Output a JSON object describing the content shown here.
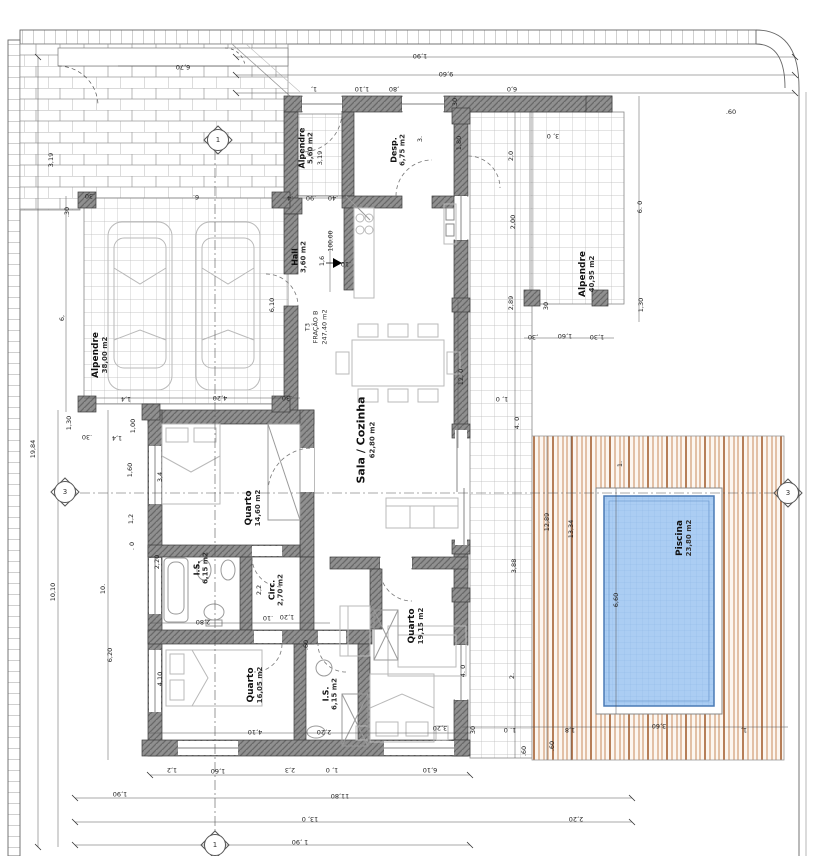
{
  "plan": {
    "fraction": {
      "line1": "T3",
      "line2": "FRAÇÃO B",
      "area": "247,40 m2"
    },
    "level_marker": "100.00",
    "rooms": [
      {
        "name": "Alpendre",
        "area": "38,00 m2",
        "x": 100,
        "y": 355,
        "fs": 9
      },
      {
        "name": "Alpendre",
        "area": "5,60 m2",
        "x": 306,
        "y": 148,
        "fs": 8
      },
      {
        "name": "Desp.",
        "area": "6,75 m2",
        "x": 398,
        "y": 150,
        "fs": 8
      },
      {
        "name": "Hall",
        "area": "3,60 m2",
        "x": 299,
        "y": 257,
        "fs": 8
      },
      {
        "name": "Sala / Cozinha",
        "area": "62,80 m2",
        "x": 366,
        "y": 440,
        "fs": 11
      },
      {
        "name": "Quarto",
        "area": "14,60 m2",
        "x": 253,
        "y": 508,
        "fs": 9
      },
      {
        "name": "I.S.",
        "area": "6,15 m2",
        "x": 201,
        "y": 568,
        "fs": 8
      },
      {
        "name": "Circ.",
        "area": "2,70 m2",
        "x": 276,
        "y": 590,
        "fs": 8
      },
      {
        "name": "Quarto",
        "area": "16,05 m2",
        "x": 255,
        "y": 685,
        "fs": 9
      },
      {
        "name": "I.S.",
        "area": "6,15 m2",
        "x": 330,
        "y": 694,
        "fs": 8
      },
      {
        "name": "Quarto",
        "area": "19,15 m2",
        "x": 416,
        "y": 626,
        "fs": 9
      },
      {
        "name": "Alpendre",
        "area": "40,95 m2",
        "x": 587,
        "y": 274,
        "fs": 9
      },
      {
        "name": "Piscina",
        "area": "23,80 m2",
        "x": 684,
        "y": 538,
        "fs": 9
      }
    ],
    "section_markers": [
      {
        "label": "1",
        "x": 218,
        "y": 140
      },
      {
        "label": "3",
        "x": 65,
        "y": 492
      },
      {
        "label": "3",
        "x": 788,
        "y": 493
      },
      {
        "label": "1",
        "x": 215,
        "y": 845
      }
    ],
    "dimensions": [
      {
        "t": "6,70",
        "x": 183,
        "y": 67,
        "r": 180
      },
      {
        "t": "1,90",
        "x": 420,
        "y": 56,
        "r": 180
      },
      {
        "t": "9,60",
        "x": 446,
        "y": 74,
        "r": 180
      },
      {
        "t": "1,",
        "x": 314,
        "y": 89,
        "r": 180
      },
      {
        "t": "1,10",
        "x": 362,
        "y": 89,
        "r": 180
      },
      {
        "t": ",80",
        "x": 394,
        "y": 89,
        "r": 180
      },
      {
        "t": "6,0",
        "x": 512,
        "y": 89,
        "r": 180
      },
      {
        "t": ".30",
        "x": 90,
        "y": 196,
        "r": 180
      },
      {
        "t": "6.",
        "x": 196,
        "y": 197,
        "r": 180
      },
      {
        "t": ".30",
        "x": 67,
        "y": 212,
        "r": -90
      },
      {
        "t": "6,",
        "x": 62,
        "y": 318,
        "r": -90
      },
      {
        "t": "6,10",
        "x": 272,
        "y": 305,
        "r": -90
      },
      {
        "t": "1,4",
        "x": 126,
        "y": 399,
        "r": 180
      },
      {
        "t": "4,20",
        "x": 220,
        "y": 398,
        "r": 180
      },
      {
        "t": ".30",
        "x": 287,
        "y": 398,
        "r": 180
      },
      {
        "t": "1,30",
        "x": 69,
        "y": 423,
        "r": -90
      },
      {
        "t": ".30",
        "x": 87,
        "y": 437,
        "r": 180
      },
      {
        "t": "1,00",
        "x": 133,
        "y": 426,
        "r": -90
      },
      {
        "t": "1,4",
        "x": 117,
        "y": 438,
        "r": 180
      },
      {
        "t": "3,19",
        "x": 51,
        "y": 160,
        "r": -90
      },
      {
        "t": "19,84",
        "x": 33,
        "y": 449,
        "r": -90
      },
      {
        "t": "10,10",
        "x": 53,
        "y": 592,
        "r": -90
      },
      {
        "t": "10.",
        "x": 103,
        "y": 589,
        "r": -90
      },
      {
        "t": "6,20",
        "x": 110,
        "y": 655,
        "r": -90
      },
      {
        "t": "1,60",
        "x": 130,
        "y": 470,
        "r": -90
      },
      {
        "t": "1,2",
        "x": 131,
        "y": 519,
        "r": -90
      },
      {
        "t": ". 0",
        "x": 132,
        "y": 546,
        "r": -90
      },
      {
        "t": "3,4",
        "x": 160,
        "y": 477,
        "r": -90
      },
      {
        "t": "2,20",
        "x": 157,
        "y": 562,
        "r": -90
      },
      {
        "t": "4,10",
        "x": 160,
        "y": 679,
        "r": -90
      },
      {
        "t": ".4",
        "x": 290,
        "y": 198,
        "r": 180
      },
      {
        "t": ".90",
        "x": 311,
        "y": 198,
        "r": 180
      },
      {
        "t": ".40",
        "x": 333,
        "y": 198,
        "r": 180
      },
      {
        "t": "3,19",
        "x": 320,
        "y": 158,
        "r": -90
      },
      {
        "t": "1,6",
        "x": 322,
        "y": 261,
        "r": -90
      },
      {
        "t": ".10",
        "x": 346,
        "y": 264,
        "r": 180
      },
      {
        "t": "3.",
        "x": 420,
        "y": 139,
        "r": -90
      },
      {
        "t": "1,80",
        "x": 459,
        "y": 143,
        "r": -90
      },
      {
        "t": ".30",
        "x": 455,
        "y": 103,
        "r": -90
      },
      {
        "t": "12, 0",
        "x": 461,
        "y": 377,
        "r": -90
      },
      {
        "t": "2,0",
        "x": 511,
        "y": 156,
        "r": -90
      },
      {
        "t": "2,00",
        "x": 513,
        "y": 222,
        "r": -90
      },
      {
        "t": "2,89",
        "x": 511,
        "y": 303,
        "r": -90
      },
      {
        "t": "4. 0",
        "x": 517,
        "y": 423,
        "r": -90
      },
      {
        "t": "3,88",
        "x": 514,
        "y": 566,
        "r": -90
      },
      {
        "t": "2.",
        "x": 512,
        "y": 676,
        "r": -90
      },
      {
        "t": "1, 0",
        "x": 502,
        "y": 399,
        "r": 180
      },
      {
        "t": "3, 0",
        "x": 553,
        "y": 136,
        "r": 180
      },
      {
        "t": ".60",
        "x": 731,
        "y": 112,
        "r": 0
      },
      {
        "t": "6. 0",
        "x": 640,
        "y": 207,
        "r": -90
      },
      {
        "t": "1,30",
        "x": 641,
        "y": 305,
        "r": -90
      },
      {
        "t": "30",
        "x": 546,
        "y": 306,
        "r": -90
      },
      {
        "t": ",30",
        "x": 533,
        "y": 337,
        "r": 180
      },
      {
        "t": "1,60",
        "x": 565,
        "y": 336,
        "r": 180
      },
      {
        "t": "1,30",
        "x": 597,
        "y": 337,
        "r": 180
      },
      {
        "t": "12,89",
        "x": 547,
        "y": 522,
        "r": -90
      },
      {
        "t": "13,34",
        "x": 571,
        "y": 529,
        "r": -90
      },
      {
        "t": "1.",
        "x": 620,
        "y": 464,
        "r": -90
      },
      {
        "t": "6,60",
        "x": 616,
        "y": 600,
        "r": -90
      },
      {
        "t": "3,60",
        "x": 659,
        "y": 726,
        "r": 180
      },
      {
        "t": "1,8",
        "x": 570,
        "y": 730,
        "r": 180
      },
      {
        "t": "1,",
        "x": 744,
        "y": 730,
        "r": 180
      },
      {
        "t": ".60",
        "x": 552,
        "y": 746,
        "r": -90
      },
      {
        "t": ".60",
        "x": 524,
        "y": 751,
        "r": -90
      },
      {
        "t": "1. 0",
        "x": 510,
        "y": 730,
        "r": 180
      },
      {
        "t": "30",
        "x": 473,
        "y": 730,
        "r": -90
      },
      {
        "t": "2,20",
        "x": 576,
        "y": 819,
        "r": 180
      },
      {
        "t": "2,2",
        "x": 259,
        "y": 590,
        "r": -90
      },
      {
        "t": "1,20",
        "x": 287,
        "y": 617,
        "r": 180
      },
      {
        "t": ".10",
        "x": 268,
        "y": 618,
        "r": 180
      },
      {
        "t": "2,80",
        "x": 203,
        "y": 622,
        "r": 180
      },
      {
        "t": ".60",
        "x": 306,
        "y": 645,
        "r": -90
      },
      {
        "t": "4,10",
        "x": 255,
        "y": 732,
        "r": 180
      },
      {
        "t": "2,20",
        "x": 324,
        "y": 732,
        "r": 180
      },
      {
        "t": "3,20",
        "x": 440,
        "y": 728,
        "r": 180
      },
      {
        "t": "4. 0",
        "x": 463,
        "y": 671,
        "r": -90
      },
      {
        "t": "1,2",
        "x": 172,
        "y": 770,
        "r": 180
      },
      {
        "t": "1,60",
        "x": 218,
        "y": 771,
        "r": 180
      },
      {
        "t": "2,3",
        "x": 290,
        "y": 770,
        "r": 180
      },
      {
        "t": "1, 0",
        "x": 332,
        "y": 770,
        "r": 180
      },
      {
        "t": "6,10",
        "x": 430,
        "y": 770,
        "r": 180
      },
      {
        "t": "1,90",
        "x": 120,
        "y": 794,
        "r": 180
      },
      {
        "t": "11,80",
        "x": 340,
        "y": 796,
        "r": 180
      },
      {
        "t": "13, 0",
        "x": 310,
        "y": 819,
        "r": 180
      },
      {
        "t": "1 ,90",
        "x": 300,
        "y": 842,
        "r": 180
      }
    ],
    "colors": {
      "deck_wood": "#b4693c",
      "pool_water": "#abcdf3",
      "wall": "#8c8c8c"
    }
  }
}
